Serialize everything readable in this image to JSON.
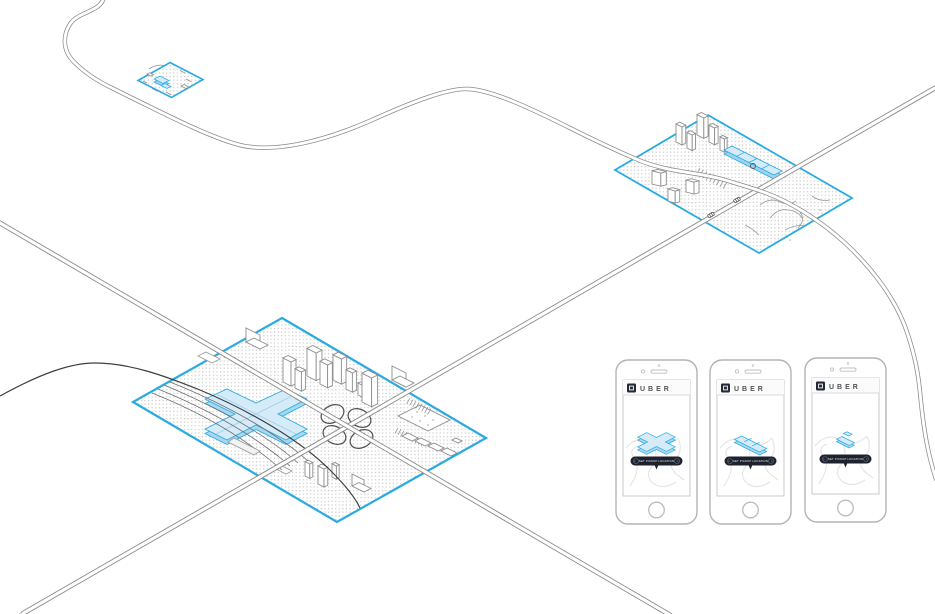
{
  "colors": {
    "accent_blue": "#29ABE2",
    "tile_fill_light_blue": "#D5EBF8",
    "tile_fill_mid_blue": "#A6D8F0",
    "pill_dark": "#1D222E",
    "logo_dark": "#232A36",
    "road_gray": "#8A8A8A",
    "rail_dark": "#3F3F3F",
    "map_road_light": "#E4E4E4",
    "dot_texture_gray": "#C6C6C6",
    "brand_text_gray": "#4F5257"
  },
  "icons": {
    "uber_logo": "uber-square-ring-logo",
    "chevron_left_glyph": "‹",
    "chevron_right_glyph": "›",
    "location_pin": "pickup-pin",
    "front_camera": "circle",
    "earpiece_speaker": "slot",
    "home_button": "circle"
  },
  "phones": [
    {
      "brand": "UBER",
      "pickup_button_label": "SET PICKUP LOCATION",
      "map_building_icon": "cross-terminal-building-icon"
    },
    {
      "brand": "UBER",
      "pickup_button_label": "SET PICKUP LOCATION",
      "map_building_icon": "strip-building-icon"
    },
    {
      "brand": "UBER",
      "pickup_button_label": "SET PICKUP LOCATION",
      "map_building_icon": "small-building-icon"
    }
  ]
}
